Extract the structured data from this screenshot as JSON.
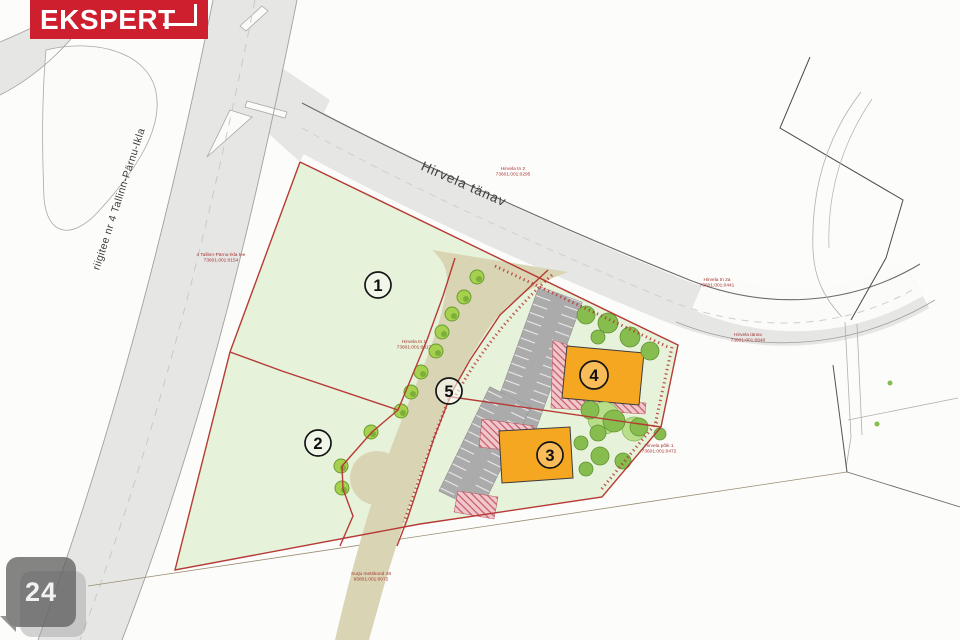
{
  "logo": {
    "text": "EKSPERT"
  },
  "photo_badge": {
    "count": "24"
  },
  "road_labels": {
    "highway": "riigitee nr 4 Tallinn-Pärnu-Ikla",
    "street": "Hirvela tänav"
  },
  "plot_numbers": {
    "p1": "1",
    "p2": "2",
    "p3": "3",
    "p4": "4",
    "p5": "5"
  },
  "cadastral_labels": [
    {
      "name": "Hirvela tn 2",
      "code": "73601:001:0295"
    },
    {
      "name": "4 Tallinn-Pärnu-Ikla tee",
      "code": "73601:001:0154"
    },
    {
      "name": "Hirvela tn 1",
      "code": "73601:001:0317"
    },
    {
      "name": "Hirvela tn 2a",
      "code": "73601:001:0441"
    },
    {
      "name": "Hirvela tänav",
      "code": "73601:001:0640"
    },
    {
      "name": "Hirvela põik 1",
      "code": "73601:001:0472"
    },
    {
      "name": "Surju metskond 48",
      "code": "95801:001:0072"
    }
  ],
  "colors": {
    "logo_red": "#ce1f2e",
    "site_green": "#e7f2da",
    "access_road_tan": "#d9d5b4",
    "building_orange": "#f6a722",
    "boundary_red": "#b63a35",
    "parking_gray": "#ababab",
    "asphalt_gray": "#e6e6e5"
  }
}
